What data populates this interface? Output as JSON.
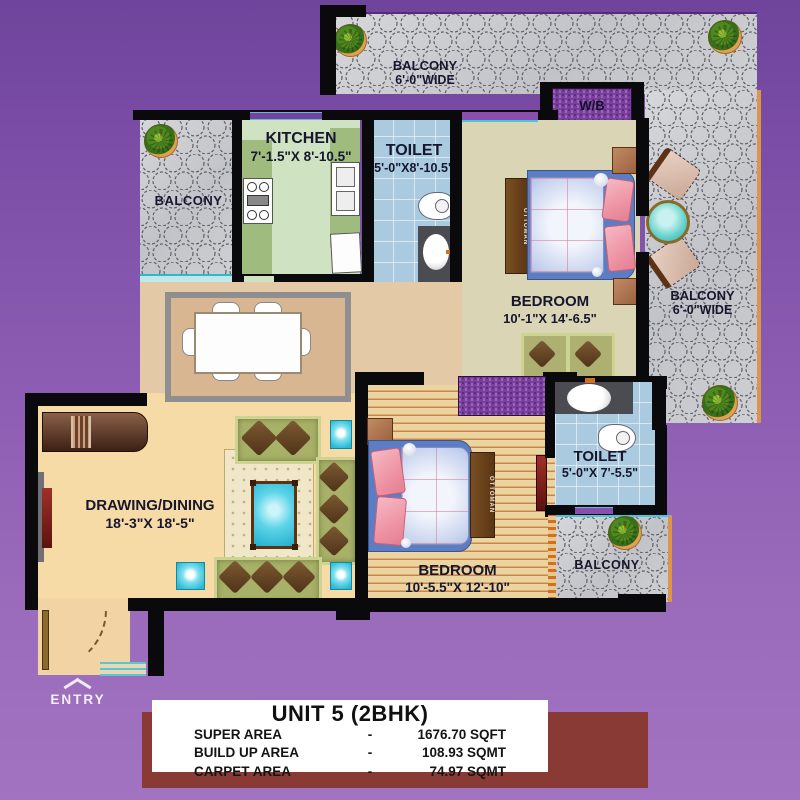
{
  "unit_info": {
    "title": "UNIT 5 (2BHK)",
    "rows": [
      {
        "label": "SUPER AREA",
        "sep": "-",
        "value": "1676.70 SQFT"
      },
      {
        "label": "BUILD UP AREA",
        "sep": "-",
        "value": "108.93 SQMT"
      },
      {
        "label": "CARPET AREA",
        "sep": "-",
        "value": "74.97 SQMT"
      }
    ]
  },
  "rooms": {
    "balcony_top": {
      "name": "BALCONY",
      "dim": "6'-0\"WIDE"
    },
    "balcony_right": {
      "name": "BALCONY",
      "dim": "6'-0\"WIDE"
    },
    "balcony_kitchen": {
      "name": "BALCONY"
    },
    "balcony_bottom": {
      "name": "BALCONY"
    },
    "kitchen": {
      "name": "KITCHEN",
      "dim": "7'-1.5\"X 8'-10.5\""
    },
    "toilet1": {
      "name": "TOILET",
      "dim": "5'-0\"X8'-10.5\""
    },
    "bedroom1": {
      "name": "BEDROOM",
      "dim": "10'-1\"X 14'-6.5\""
    },
    "drawing": {
      "name": "DRAWING/DINING",
      "dim": "18'-3\"X 18'-5\""
    },
    "bedroom2": {
      "name": "BEDROOM",
      "dim": "10'-5.5\"X 12'-10\""
    },
    "toilet2": {
      "name": "TOILET",
      "dim": "5'-0\"X 7'-5.5\""
    },
    "wb": {
      "label": "W/B"
    },
    "entry": {
      "label": "ENTRY"
    },
    "ottoman1": {
      "label": "OTTOMAN"
    },
    "ottoman2": {
      "label": "OTTOMAN"
    }
  },
  "colors": {
    "background_purple": "#8a5bb1",
    "wall_black": "#0a0a0c",
    "balcony_tile_gray": "#c9cace",
    "kitchen_floor": "#cfe3c3",
    "kitchen_counter": "#9fbb7d",
    "toilet_tile_blue": "#a9cadf",
    "bedroom1_floor": "#d9d5b5",
    "bedroom2_wood": "#ead49f",
    "drawing_floor": "#f7dba6",
    "dining_rug": "#d8b691",
    "sofa_green": "#a8b168",
    "cushion_brown": "#5e3f20",
    "accent_teal": "#3ec6de",
    "bed_blue": "#5c7cc4",
    "pillow_pink": "#ee93a4",
    "wardrobe_purple": "#7a3f9e",
    "info_maroon": "#8a3a34",
    "info_white": "#ffffff"
  }
}
